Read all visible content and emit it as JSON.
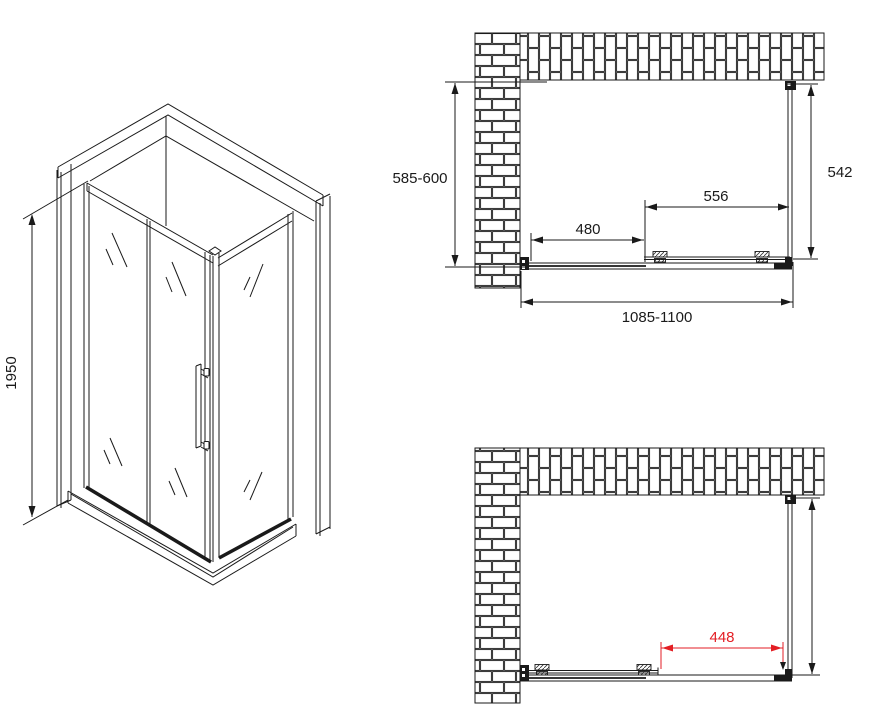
{
  "colors": {
    "line": "#1a1a1a",
    "dimension_red": "#e31e24"
  },
  "isometric_view": {
    "height_label": "1950"
  },
  "plan_view_closed": {
    "depth_label": "585-600",
    "side_panel_label": "542",
    "door_width_label": "556",
    "fixed_panel_label": "480",
    "total_width_label": "1085-1100"
  },
  "plan_view_open": {
    "opening_label": "448"
  }
}
